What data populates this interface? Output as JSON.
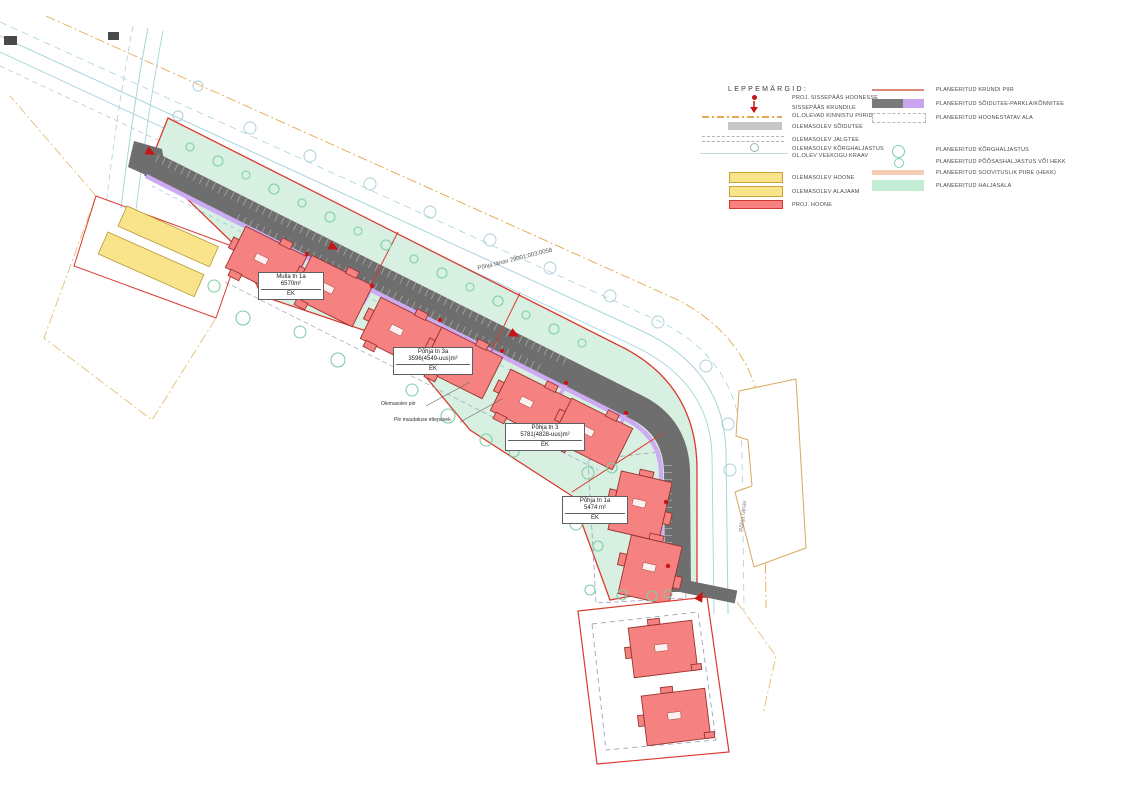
{
  "legend": {
    "title": "LEPPEMÄRGID:",
    "left_items": [
      {
        "symbol": "entrance-to-building-dot",
        "label": "PROJ. SISSEPÄÄS HOONESSE"
      },
      {
        "symbol": "entrance-to-plot-arrow",
        "label": "SISSEPÄÄS KRUNDILE"
      },
      {
        "symbol": "existing-cadastral-boundary-line",
        "label": "OL.OLEVAD KINNISTU PIIRID"
      },
      {
        "symbol": "existing-road-bar",
        "label": "OLEMASOLEV SÕIDUTEE"
      },
      {
        "symbol": "existing-footpath-dashed",
        "label": "OLEMASOLEV JALGTEE"
      },
      {
        "symbol": "existing-tall-greenery-circle",
        "label": "OLEMASOLEV KÕRGHALJASTUS"
      },
      {
        "symbol": "existing-waterbody-line",
        "label": "OL.OLEV VEEKOGU KRAAV"
      },
      {
        "symbol": "existing-building-swatch",
        "label": "OLEMASOLEV HOONE"
      },
      {
        "symbol": "existing-substation-swatch",
        "label": "OLEMASOLEV ALAJAAM"
      },
      {
        "symbol": "proj-building-swatch",
        "label": "PROJ. HOONE"
      }
    ],
    "right_items": [
      {
        "symbol": "planned-plot-boundary-line",
        "label": "PLANEERITUD KRUNDI PIIR"
      },
      {
        "symbol": "planned-road-parking-walkway-swatch",
        "label": "PLANEERITUD SÕIDUTEE-PARKLA/KÕNNITEE"
      },
      {
        "symbol": "planned-buildable-area-dashed-box",
        "label": "PLANEERITUD HOONESTATAV ALA"
      },
      {
        "symbol": "planned-tall-greenery-circle",
        "label": "PLANEERITUD KÕRGHALJASTUS"
      },
      {
        "symbol": "planned-shrubs-or-hedge-circle",
        "label": "PLANEERITUD PÕÕSASHALJASTUS VÕI HEKK"
      },
      {
        "symbol": "planned-recommended-fence-swatch",
        "label": "PLANEERITUD SOOVITUSLIK PIIRE (HEKK)"
      },
      {
        "symbol": "planned-green-area-swatch",
        "label": "PLANEERITUD HALJASALA"
      }
    ]
  },
  "plan": {
    "plots": [
      {
        "name": "Mulla tn 1a",
        "area": "6570m²",
        "zoning": "EK"
      },
      {
        "name": "Põhja tn 3a",
        "area": "3596(4549-uus)m²",
        "zoning": "EK"
      },
      {
        "name": "Põhja tn 3",
        "area": "5781(4828-uus)m²",
        "zoning": "EK"
      },
      {
        "name": "Põhja tn 1a",
        "area": "5474 m²",
        "zoning": "EK"
      }
    ],
    "annotations": [
      {
        "label": "Olemasolev piir"
      },
      {
        "label": "Piir muudatuse ettepanek"
      }
    ],
    "street_labels": [
      {
        "label": "Põhja tänav 29001:003:0058"
      },
      {
        "label": "Põhja tänav"
      }
    ]
  },
  "colors": {
    "planned_green_area": "#d7f0e2",
    "road_gray": "#6e6e6e",
    "walkway_purple": "#cdabf2",
    "proj_building_red": "#f58181",
    "existing_building_yellow": "#f9e48b",
    "planned_boundary_red": "#d93a2e",
    "planned_tree_green": "#7fcfa6",
    "existing_water_cyan": "#a8d4dc",
    "cadastral_orange": "#e6a84f",
    "fence_peach": "#f6cdb4"
  }
}
